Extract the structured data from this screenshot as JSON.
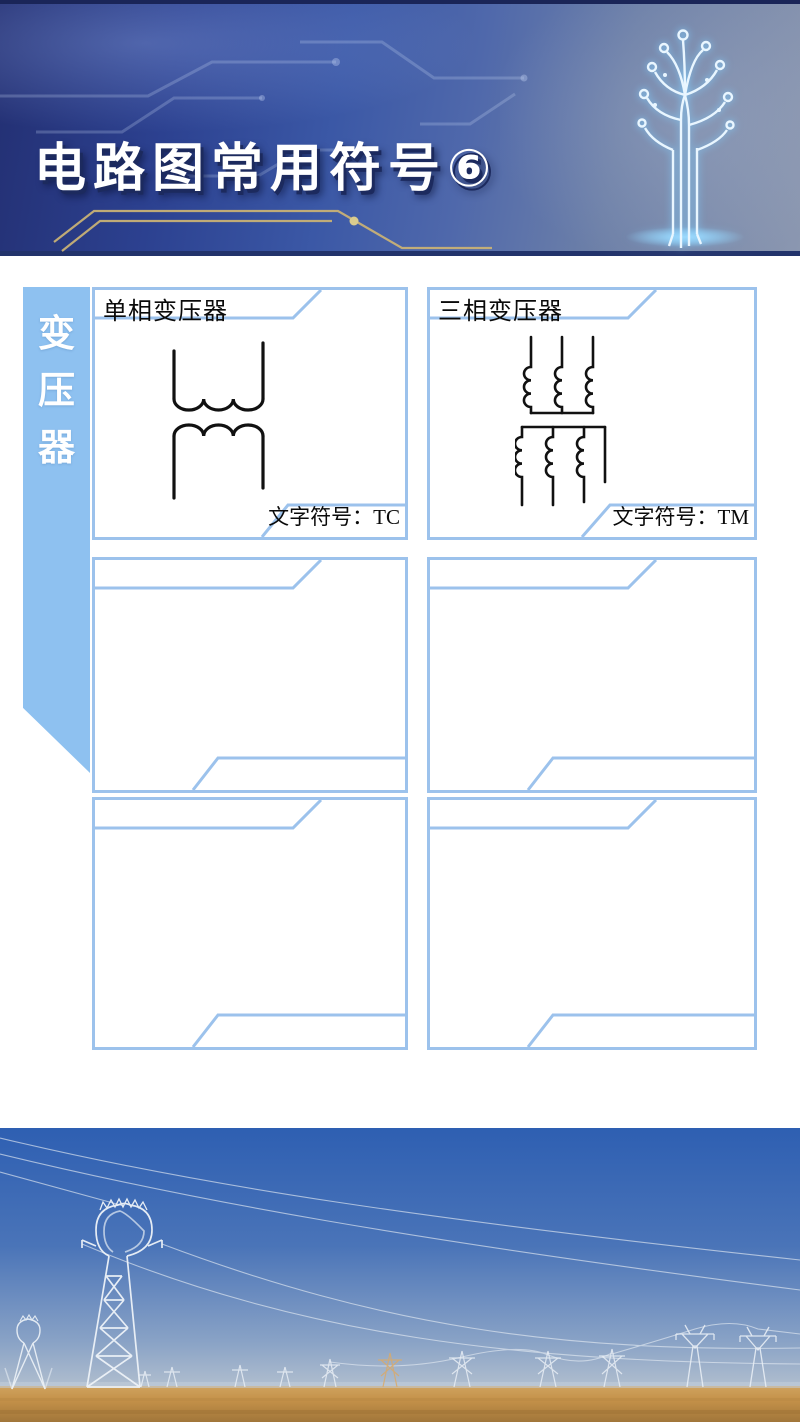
{
  "header": {
    "title": "电路图常用符号⑥"
  },
  "sidebar": {
    "label": "变压器",
    "chars": [
      "变",
      "压",
      "器"
    ]
  },
  "cells": [
    {
      "title": "单相变压器",
      "footer": "文字符号：TC",
      "symbol": "single-phase-transformer"
    },
    {
      "title": "三相变压器",
      "footer": "文字符号：TM",
      "symbol": "three-phase-transformer"
    },
    {
      "title": "",
      "footer": "",
      "symbol": ""
    },
    {
      "title": "",
      "footer": "",
      "symbol": ""
    },
    {
      "title": "",
      "footer": "",
      "symbol": ""
    },
    {
      "title": "",
      "footer": "",
      "symbol": ""
    }
  ],
  "colors": {
    "cell_border": "#9cc2ec",
    "sidebar_bg": "#8ec1f0",
    "symbol_ink": "#111111",
    "header_navy": "#232f72",
    "header_steel": "#8b97b0",
    "gold_trace": "#c8b176",
    "tree_glow": "#7fd0ff",
    "sky_top": "#2e5fb2",
    "sky_horizon": "#b3c0cf",
    "ground": "#c49149"
  }
}
